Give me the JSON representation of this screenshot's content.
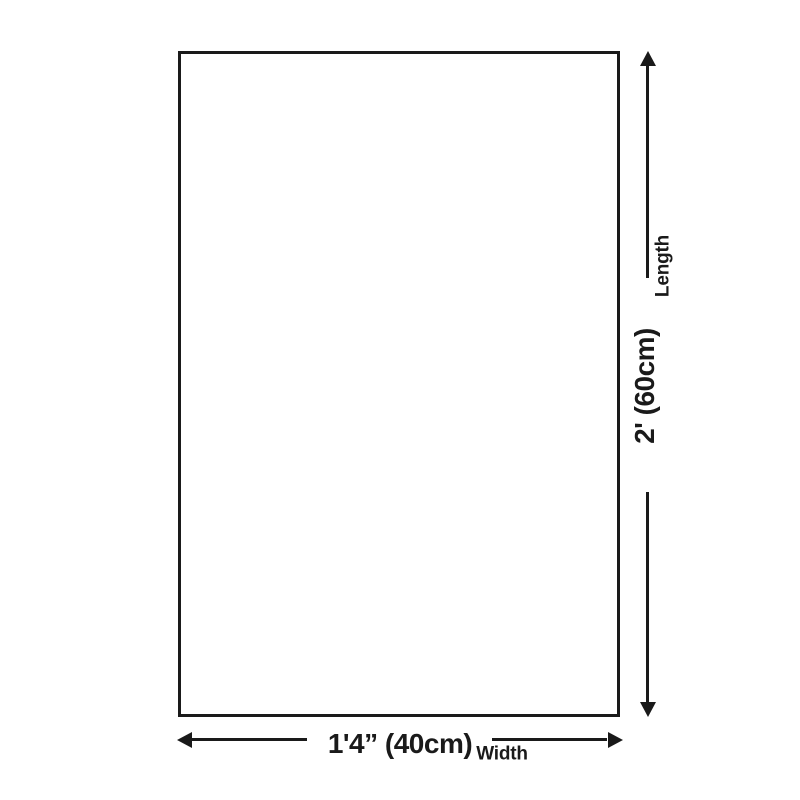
{
  "diagram": {
    "background_color": "#ffffff",
    "line_color": "#1a1a1a",
    "length_dimension": {
      "value": "2' (60cm)",
      "label": "Length"
    },
    "width_dimension": {
      "value": "1'4” (40cm)",
      "label": "Width"
    }
  }
}
